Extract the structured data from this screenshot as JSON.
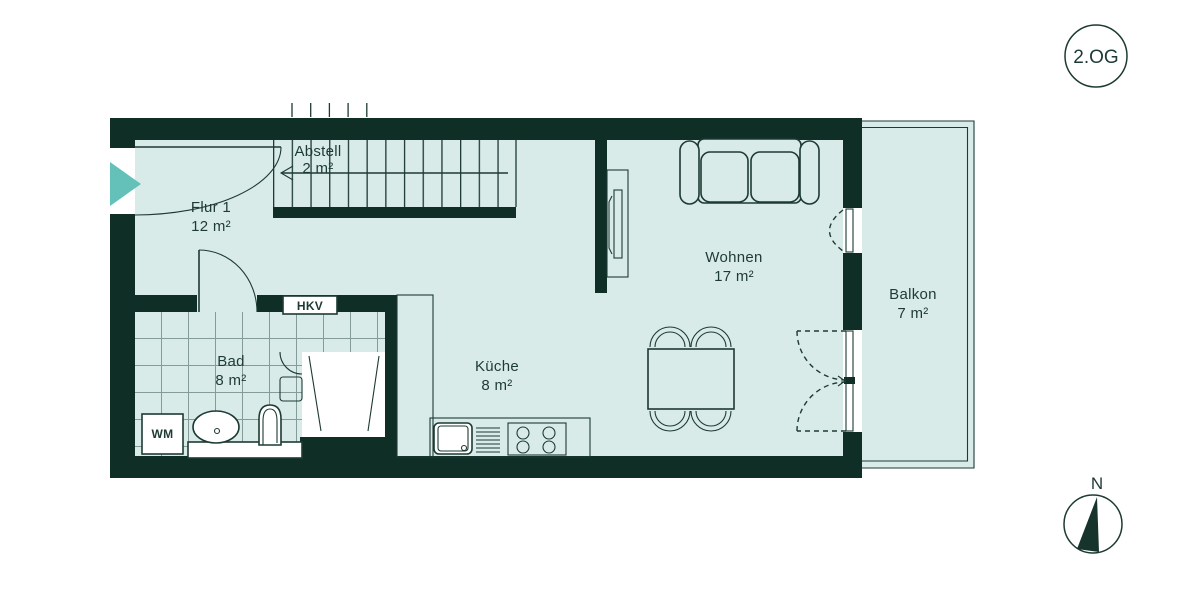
{
  "floor_badge": {
    "label": "2.OG"
  },
  "compass": {
    "north_label": "N"
  },
  "rooms": [
    {
      "name": "Flur 1",
      "area": "12 m²"
    },
    {
      "name": "Abstell",
      "area": "2 m²"
    },
    {
      "name": "Bad",
      "area": "8 m²"
    },
    {
      "name": "Küche",
      "area": "8 m²"
    },
    {
      "name": "Wohnen",
      "area": "17 m²"
    },
    {
      "name": "Balkon",
      "area": "7 m²"
    }
  ],
  "fixtures": {
    "hkv_label": "HKV",
    "washing_machine_label": "WM"
  },
  "colors": {
    "wall": "#0f2e26",
    "room_fill": "#d9ebe9",
    "line": "#1d3a33",
    "accent": "#63c1b9",
    "white": "#ffffff"
  }
}
